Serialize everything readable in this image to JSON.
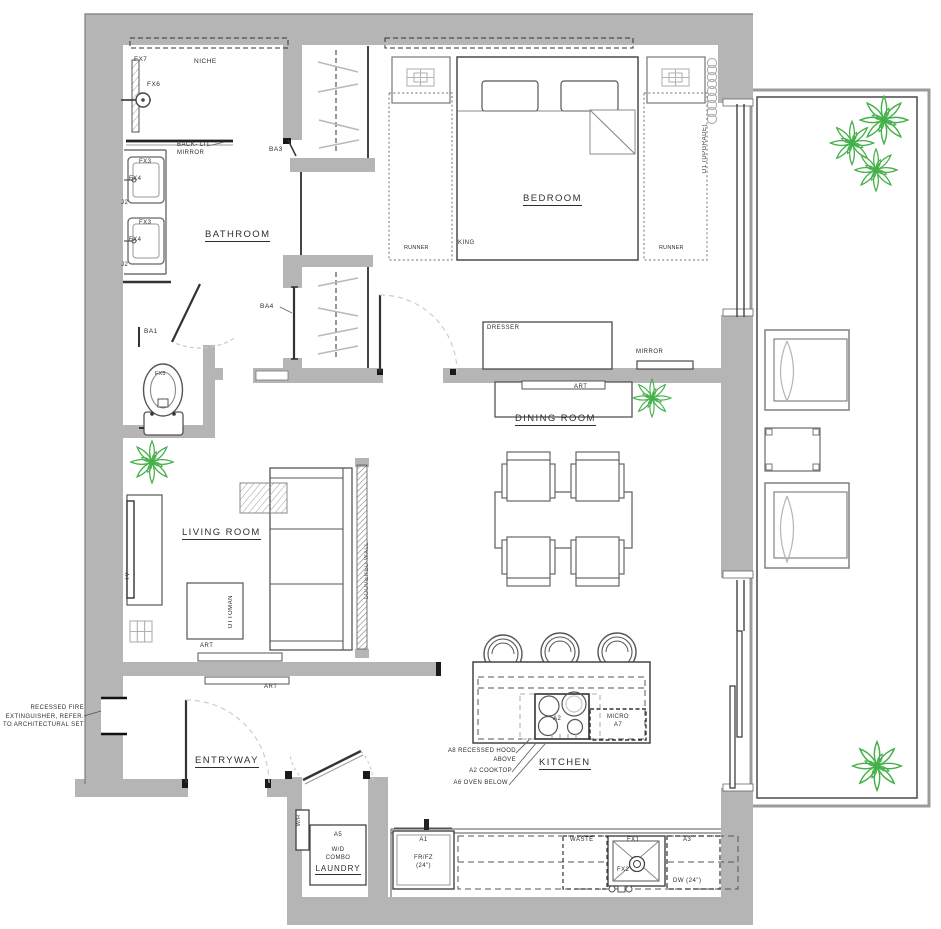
{
  "colors": {
    "wall": "#b5b5b5",
    "line": "#4a4a4a",
    "light_line": "#aaaaaa",
    "dash_arc": "#c8c8c8",
    "plant_green": "#44b049",
    "text": "#2e2e2e"
  },
  "rooms": {
    "bathroom": "BATHROOM",
    "bedroom": "BEDROOM",
    "dining_room": "DINING ROOM",
    "living_room": "LIVING ROOM",
    "entryway": "ENTRYWAY",
    "kitchen": "KITCHEN",
    "laundry": "LAUNDRY"
  },
  "bathroom": {
    "niche": "NICHE",
    "fx7": "FX7",
    "fx6": "FX6",
    "fx5": "FX5",
    "fx3": "FX3",
    "fx4": "FX4",
    "j2": "J2",
    "mirror_note_1": "BACK- LIT",
    "mirror_note_2": "MIRROR",
    "door": "BA1"
  },
  "closets": {
    "ba3": "BA3",
    "ba4": "BA4"
  },
  "bedroom": {
    "bed": "KING",
    "runner": "RUNNER",
    "dresser": "DRESSER",
    "mirror": "MIRROR",
    "window": "D1 (UPGRADE)"
  },
  "dining": {
    "art": "ART"
  },
  "living": {
    "tv": "TV",
    "ottoman": "OTTOMAN",
    "art": "ART",
    "louvered": "LOUVERED WALL"
  },
  "entry": {
    "note_1": "RECESSED FIRE",
    "note_2": "EXTINGUISHER, REFER.",
    "note_3": "TO ARCHITECTURAL SET",
    "art": "ART"
  },
  "kitchen": {
    "cooktop_tag": "A2",
    "micro_1": "MICRO",
    "micro_2": "A7",
    "note_hood_1": "A8 RECESSED HOOD",
    "note_hood_2": "ABOVE",
    "note_cooktop": "A2 COOKTOP",
    "note_oven": "A6 OVEN BELOW",
    "fridge_1": "A1",
    "fridge_2": "FR/FZ",
    "fridge_3": "(24\")",
    "waste": "WASTE",
    "sink": "FX1",
    "faucet": "FX2",
    "dw_1": "A3",
    "dw_2": "DW (24\")"
  },
  "laundry": {
    "wh": "W/H",
    "a5": "A5",
    "wd_1": "W/D",
    "wd_2": "COMBO"
  }
}
